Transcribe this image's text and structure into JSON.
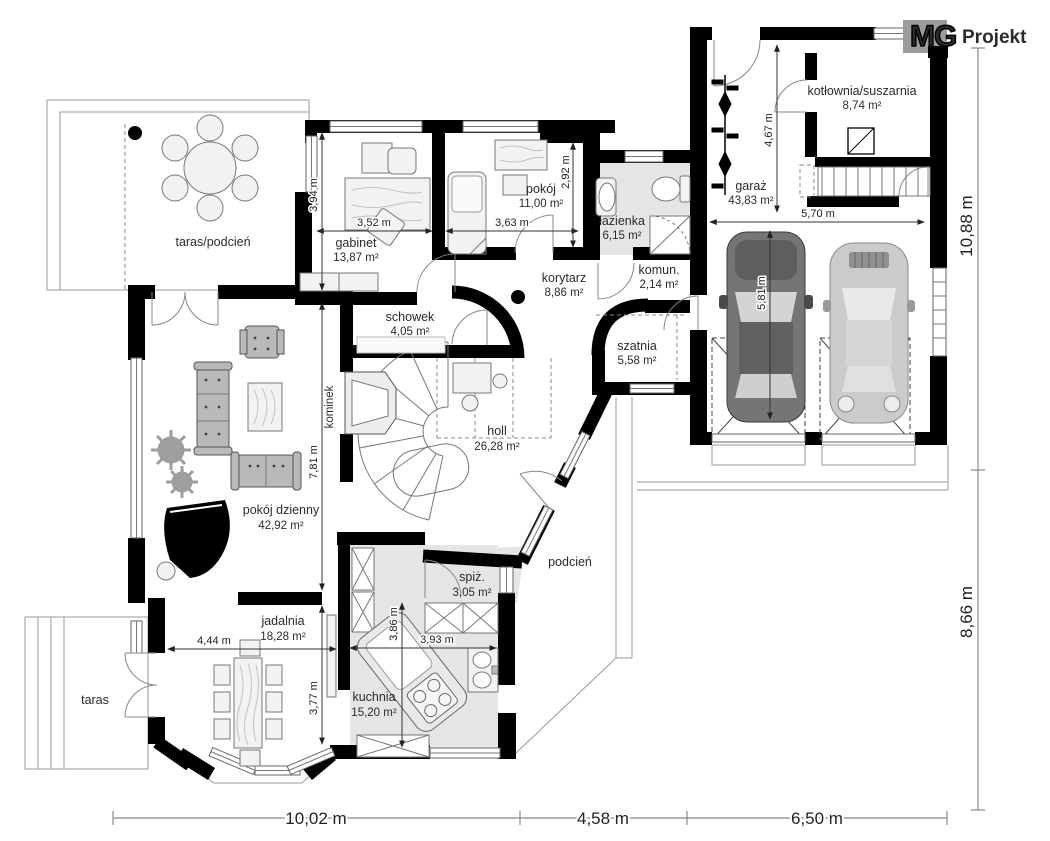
{
  "logo": {
    "mg": "MG",
    "projekt": "Projekt"
  },
  "rooms": {
    "taras_podcien": {
      "name": "taras/podcień"
    },
    "gabinet": {
      "name": "gabinet",
      "area": "13,87 m²"
    },
    "pokoj": {
      "name": "pokój",
      "area": "11,00 m²"
    },
    "lazienka": {
      "name": "łazienka",
      "area": "6,15 m²"
    },
    "korytarz": {
      "name": "korytarz",
      "area": "8,86 m²"
    },
    "komun": {
      "name": "komun.",
      "area": "2,14 m²"
    },
    "schowek": {
      "name": "schowek",
      "area": "4,05 m²"
    },
    "szatnia": {
      "name": "szatnia",
      "area": "5,58 m²"
    },
    "holl": {
      "name": "holl",
      "area": "26,28 m²"
    },
    "kominek": {
      "name": "kominek"
    },
    "pokoj_dzienny": {
      "name": "pokój dzienny",
      "area": "42,92 m²"
    },
    "jadalnia": {
      "name": "jadalnia",
      "area": "18,28 m²"
    },
    "kuchnia": {
      "name": "kuchnia",
      "area": "15,20 m²"
    },
    "spiz": {
      "name": "spiż.",
      "area": "3,05 m²"
    },
    "podcien": {
      "name": "podcień"
    },
    "taras": {
      "name": "taras"
    },
    "kotlownia": {
      "name": "kotłownia/suszarnia",
      "area": "8,74 m²"
    },
    "garaz": {
      "name": "garaż",
      "area": "43,83 m²"
    }
  },
  "dimensions": {
    "gabinet_w": "3,52 m",
    "gabinet_h": "3,94 m",
    "pokoj_w": "3,63 m",
    "pokoj_h": "2,92 m",
    "garaz_h": "4,67 m",
    "garaz_w": "5,70 m",
    "car_l": "5,81 m",
    "living_h": "7,81 m",
    "jadalnia_w": "4,44 m",
    "jadalnia_h": "3,77 m",
    "kuchnia_w": "3,93 m",
    "kuchnia_h": "3,86 m",
    "bottom_left": "10,02 m",
    "bottom_mid": "4,58 m",
    "bottom_right": "6,50 m",
    "right_top": "10,88 m",
    "right_bottom": "8,66 m"
  }
}
